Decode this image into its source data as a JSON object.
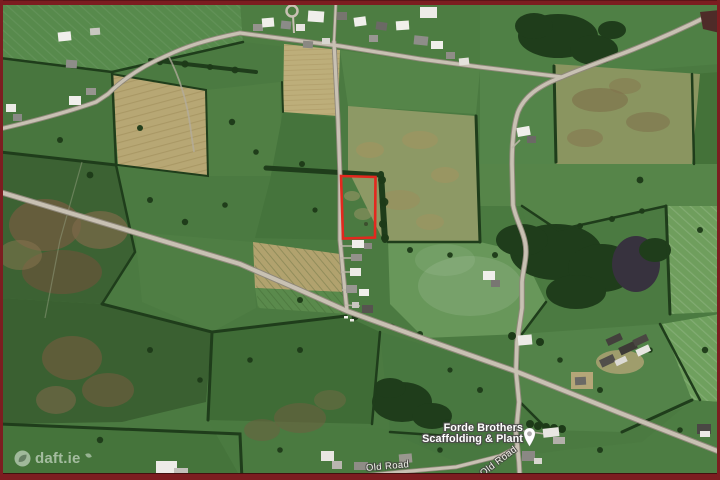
{
  "frame": {
    "border_color": "#7c1d20"
  },
  "map": {
    "kind": "satellite-aerial-view",
    "property_boundary": {
      "color": "#e3281e"
    },
    "poi_label": {
      "line1": "Forde Brothers",
      "line2": "Scaffolding & Plant"
    },
    "poi_pin": {
      "icon": "white-map-pin",
      "fill": "#ffffff"
    },
    "road_labels": [
      {
        "text": "Old Road"
      },
      {
        "text": "Old Road"
      }
    ],
    "watermark": {
      "text": "daft.ie",
      "icon": "daft-leaf-logo"
    }
  }
}
